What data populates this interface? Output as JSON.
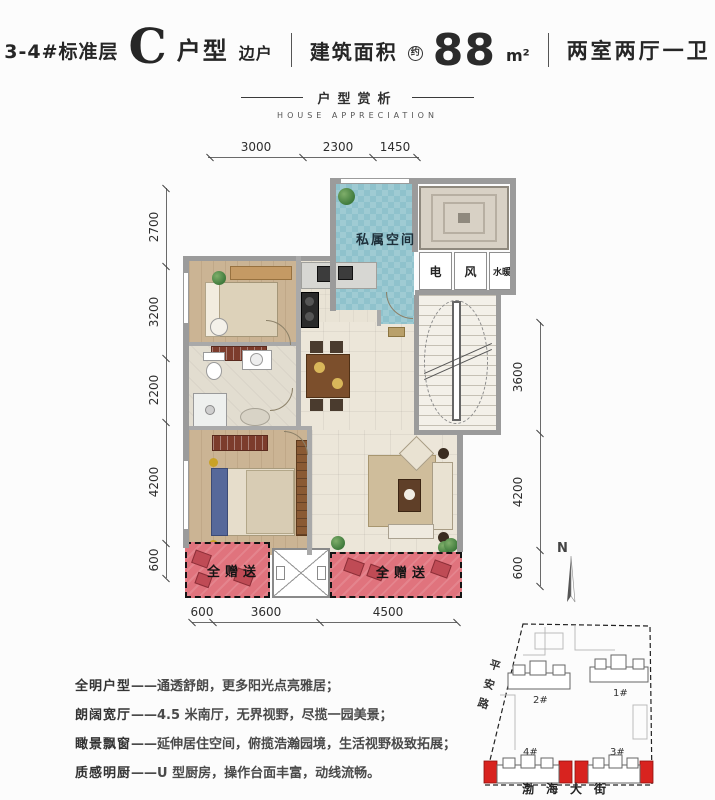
{
  "header": {
    "floor_label": "3-4#标准层",
    "unit_letter": "C",
    "unit_type": "户型",
    "unit_position": "边户",
    "area_label": "建筑面积",
    "area_circle": "约",
    "area_value": "88",
    "area_unit": "m²",
    "rooms_label": "两室两厅一卫"
  },
  "section_header": {
    "title": "户型赏析",
    "subtitle": "HOUSE APPRECIATION"
  },
  "plan": {
    "room_labels": {
      "private_space": "私属空间",
      "shaft_electric": "电",
      "shaft_vent": "风",
      "shaft_water": "水暖",
      "gift_left": "全赠送",
      "gift_right": "全赠送"
    },
    "dimensions": {
      "top": [
        "3000",
        "2300",
        "1450"
      ],
      "left": [
        "2700",
        "3200",
        "2200",
        "4200",
        "600"
      ],
      "right": [
        "3600",
        "4200",
        "600"
      ],
      "bottom": [
        "600",
        "3600",
        "4500"
      ]
    }
  },
  "features": [
    {
      "term": "全明户型",
      "desc": "——通透舒朗，更多阳光点亮雅居；"
    },
    {
      "term": "朗阔宽厅",
      "desc": "——4.5 米南厅，无界视野，尽揽一园美景；"
    },
    {
      "term": "瞰景飘窗",
      "desc": "——延伸居住空间，俯揽浩瀚园境，生活视野极致拓展；"
    },
    {
      "term": "质感明厨",
      "desc": "——U 型厨房，操作台面丰富，动线流畅。"
    }
  ],
  "site_map": {
    "north_label": "N",
    "road_left": "平安路",
    "road_bottom": "渤海大街",
    "buildings": [
      {
        "label": "1#"
      },
      {
        "label": "2#"
      },
      {
        "label": "3#"
      },
      {
        "label": "4#"
      }
    ]
  },
  "colors": {
    "private_space_fill": "#8fc2cc",
    "gift_area_fill": "#e0737d",
    "highlight_red": "#d8231f",
    "wall_gray": "#9b9b9b"
  }
}
